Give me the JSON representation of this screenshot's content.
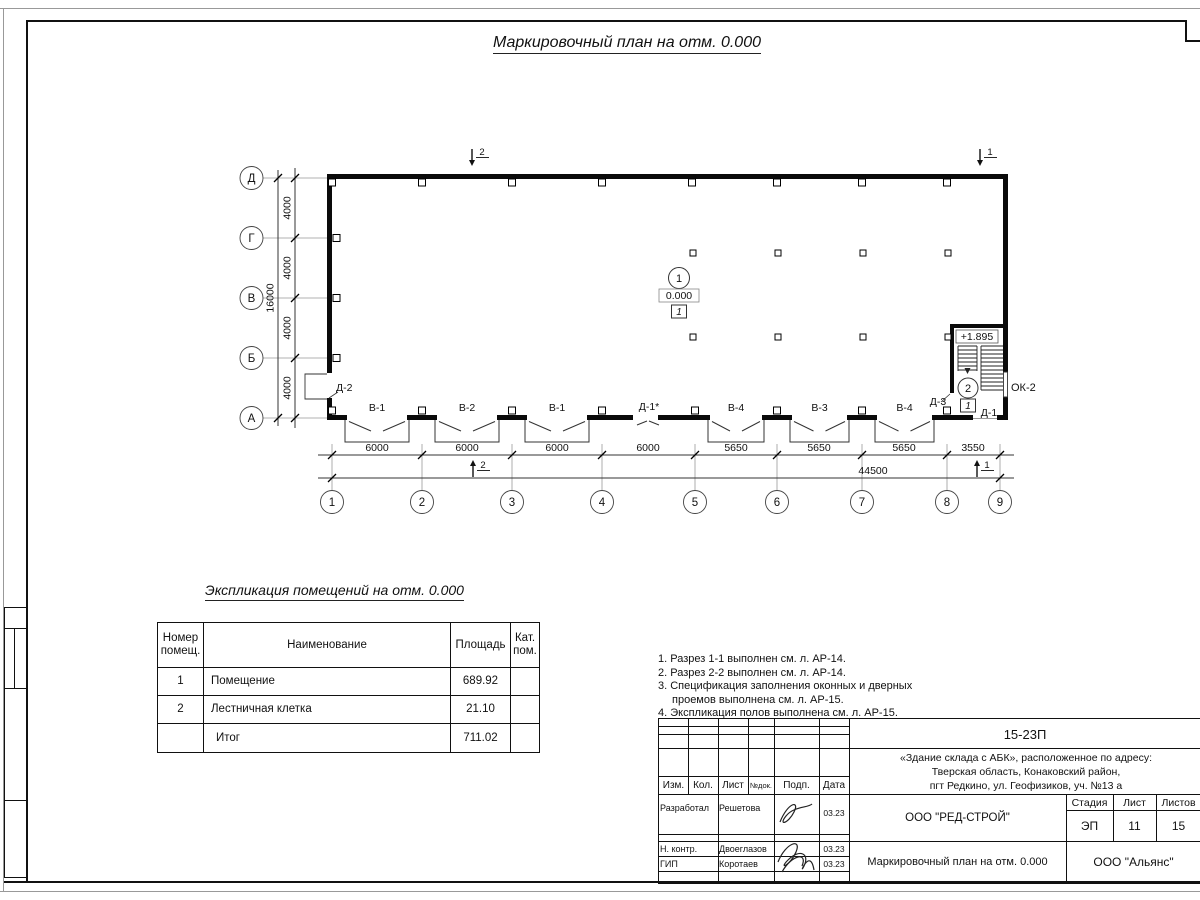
{
  "sheet": {
    "title": "Маркировочный план на отм. 0.000"
  },
  "plan": {
    "row_axes": [
      "Д",
      "Г",
      "В",
      "Б",
      "А"
    ],
    "col_axes": [
      "1",
      "2",
      "3",
      "4",
      "5",
      "6",
      "7",
      "8",
      "9"
    ],
    "v_dims": [
      "4000",
      "4000",
      "4000",
      "4000"
    ],
    "v_total": "16000",
    "h_dims": [
      "6000",
      "6000",
      "6000",
      "6000",
      "5650",
      "5650",
      "5650",
      "3550"
    ],
    "h_total": "44500",
    "window_labels": [
      "В-1",
      "В-2",
      "В-1",
      "В-4",
      "В-3",
      "В-4"
    ],
    "door_d1star": "Д-1*",
    "door_d2": "Д-2",
    "door_d3": "Д-3",
    "door_d1": "Д-1",
    "window_ok2": "ОК-2",
    "room1": {
      "num": "1",
      "elev": "0.000",
      "floor": "1"
    },
    "stair": {
      "num": "2",
      "elev": "+1.895",
      "floor": "1"
    },
    "sections": {
      "top_left": "2",
      "top_right": "1",
      "bottom_left": "2",
      "bottom_right": "1"
    }
  },
  "schedule": {
    "title": "Экспликация помещений на отм. 0.000",
    "headers": [
      "Номер помещ.",
      "Наименование",
      "Площадь",
      "Кат. пом."
    ],
    "rows": [
      {
        "num": "1",
        "name": "Помещение",
        "area": "689.92",
        "cat": ""
      },
      {
        "num": "2",
        "name": "Лестничная клетка",
        "area": "21.10",
        "cat": ""
      },
      {
        "num": "",
        "name": "Итог",
        "area": "711.02",
        "cat": ""
      }
    ]
  },
  "notes": {
    "n1": "1. Разрез 1-1 выполнен см. л. АР-14.",
    "n2": "2. Разрез 2-2 выполнен см. л. АР-14.",
    "n3": "3. Спецификация заполнения оконных и дверных проемов выполнена см. л. АР-15.",
    "n4": "4. Экспликация полов выполнена см. л. АР-15."
  },
  "titleblock": {
    "code": "15-23П",
    "object_line1": "«Здание склада с АБК», расположенное по адресу:",
    "object_line2": "Тверская область, Конаковский район,",
    "object_line3": "пгт Редкино, ул. Геофизиков, уч. №13 а",
    "col_headers": {
      "izm": "Изм.",
      "kol": "Кол.",
      "list": "Лист",
      "ndok": "№док.",
      "podp": "Подп.",
      "data": "Дата"
    },
    "row1": {
      "role": "Разработал",
      "name": "Решетова",
      "date": "03.23"
    },
    "row2": {
      "role": "Н. контр.",
      "name": "Двоеглазов",
      "date": "03.23"
    },
    "row3": {
      "role": "ГИП",
      "name": "Коротаев",
      "date": "03.23"
    },
    "org": "ООО \"РЕД-СТРОЙ\"",
    "stage_label": "Стадия",
    "list_label": "Лист",
    "listov_label": "Листов",
    "stage": "ЭП",
    "list_num": "11",
    "listov_num": "15",
    "doc_title": "Маркировочный план на отм. 0.000",
    "company": "ООО \"Альянс\""
  }
}
